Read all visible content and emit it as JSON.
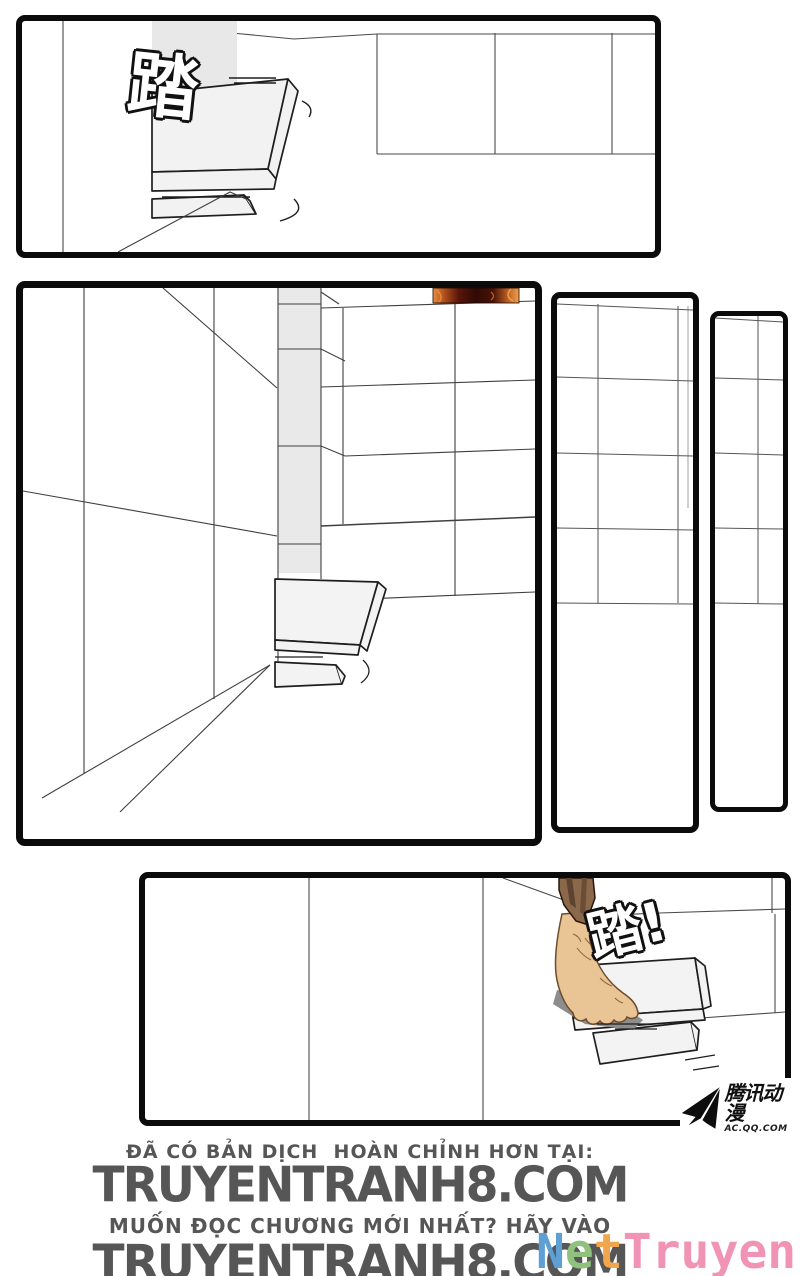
{
  "page": {
    "width": 800,
    "height": 1276,
    "background": "#ffffff",
    "panel_border_color": "#0b0b0b",
    "line_color": "#3f3f3f"
  },
  "sfx": {
    "top": "踏",
    "bottom": "踏!"
  },
  "tencent": {
    "brand": "腾讯动漫",
    "site": "AC.QQ.COM",
    "color": "#101010"
  },
  "nettruyen": {
    "text": "NetTruyen",
    "letters": [
      {
        "ch": "N",
        "style": "color:#5e9fd4"
      },
      {
        "ch": "e",
        "style": "color:#90c17e"
      },
      {
        "ch": "t",
        "style": "color:#f0a64e"
      },
      {
        "ch": "T",
        "style": "color:#f193b4"
      },
      {
        "ch": "r",
        "style": "color:#f193b4"
      },
      {
        "ch": "u",
        "style": "color:#f193b4"
      },
      {
        "ch": "y",
        "style": "color:#f193b4"
      },
      {
        "ch": "e",
        "style": "color:#f193b4"
      },
      {
        "ch": "n",
        "style": "color:#f193b4"
      }
    ]
  },
  "footer": {
    "line1": "ĐÃ CÓ BẢN DỊCH  HOÀN CHỈNH HƠN TẠI:",
    "site1": "TRUYENTRANH8.COM",
    "line2": "MUỐN ĐỌC CHƯƠNG MỚI NHẤT? HÃY VÀO",
    "site2": "TRUYENTRANH8.COM",
    "text_color": "#565656"
  },
  "art_colors": {
    "tile_gray": "#e9e9e9",
    "step_gray": "#f3f3f3",
    "fire_dark": "#330a04",
    "fire_orange": "#c2661f",
    "fire_bright": "#f0a04c",
    "robe_brown": "#8b6849",
    "robe_fold_dark": "#5d4330",
    "skin": "#e9c495",
    "skin_outline": "#6d4b2b",
    "shadow_gray": "#8d8d8d"
  }
}
